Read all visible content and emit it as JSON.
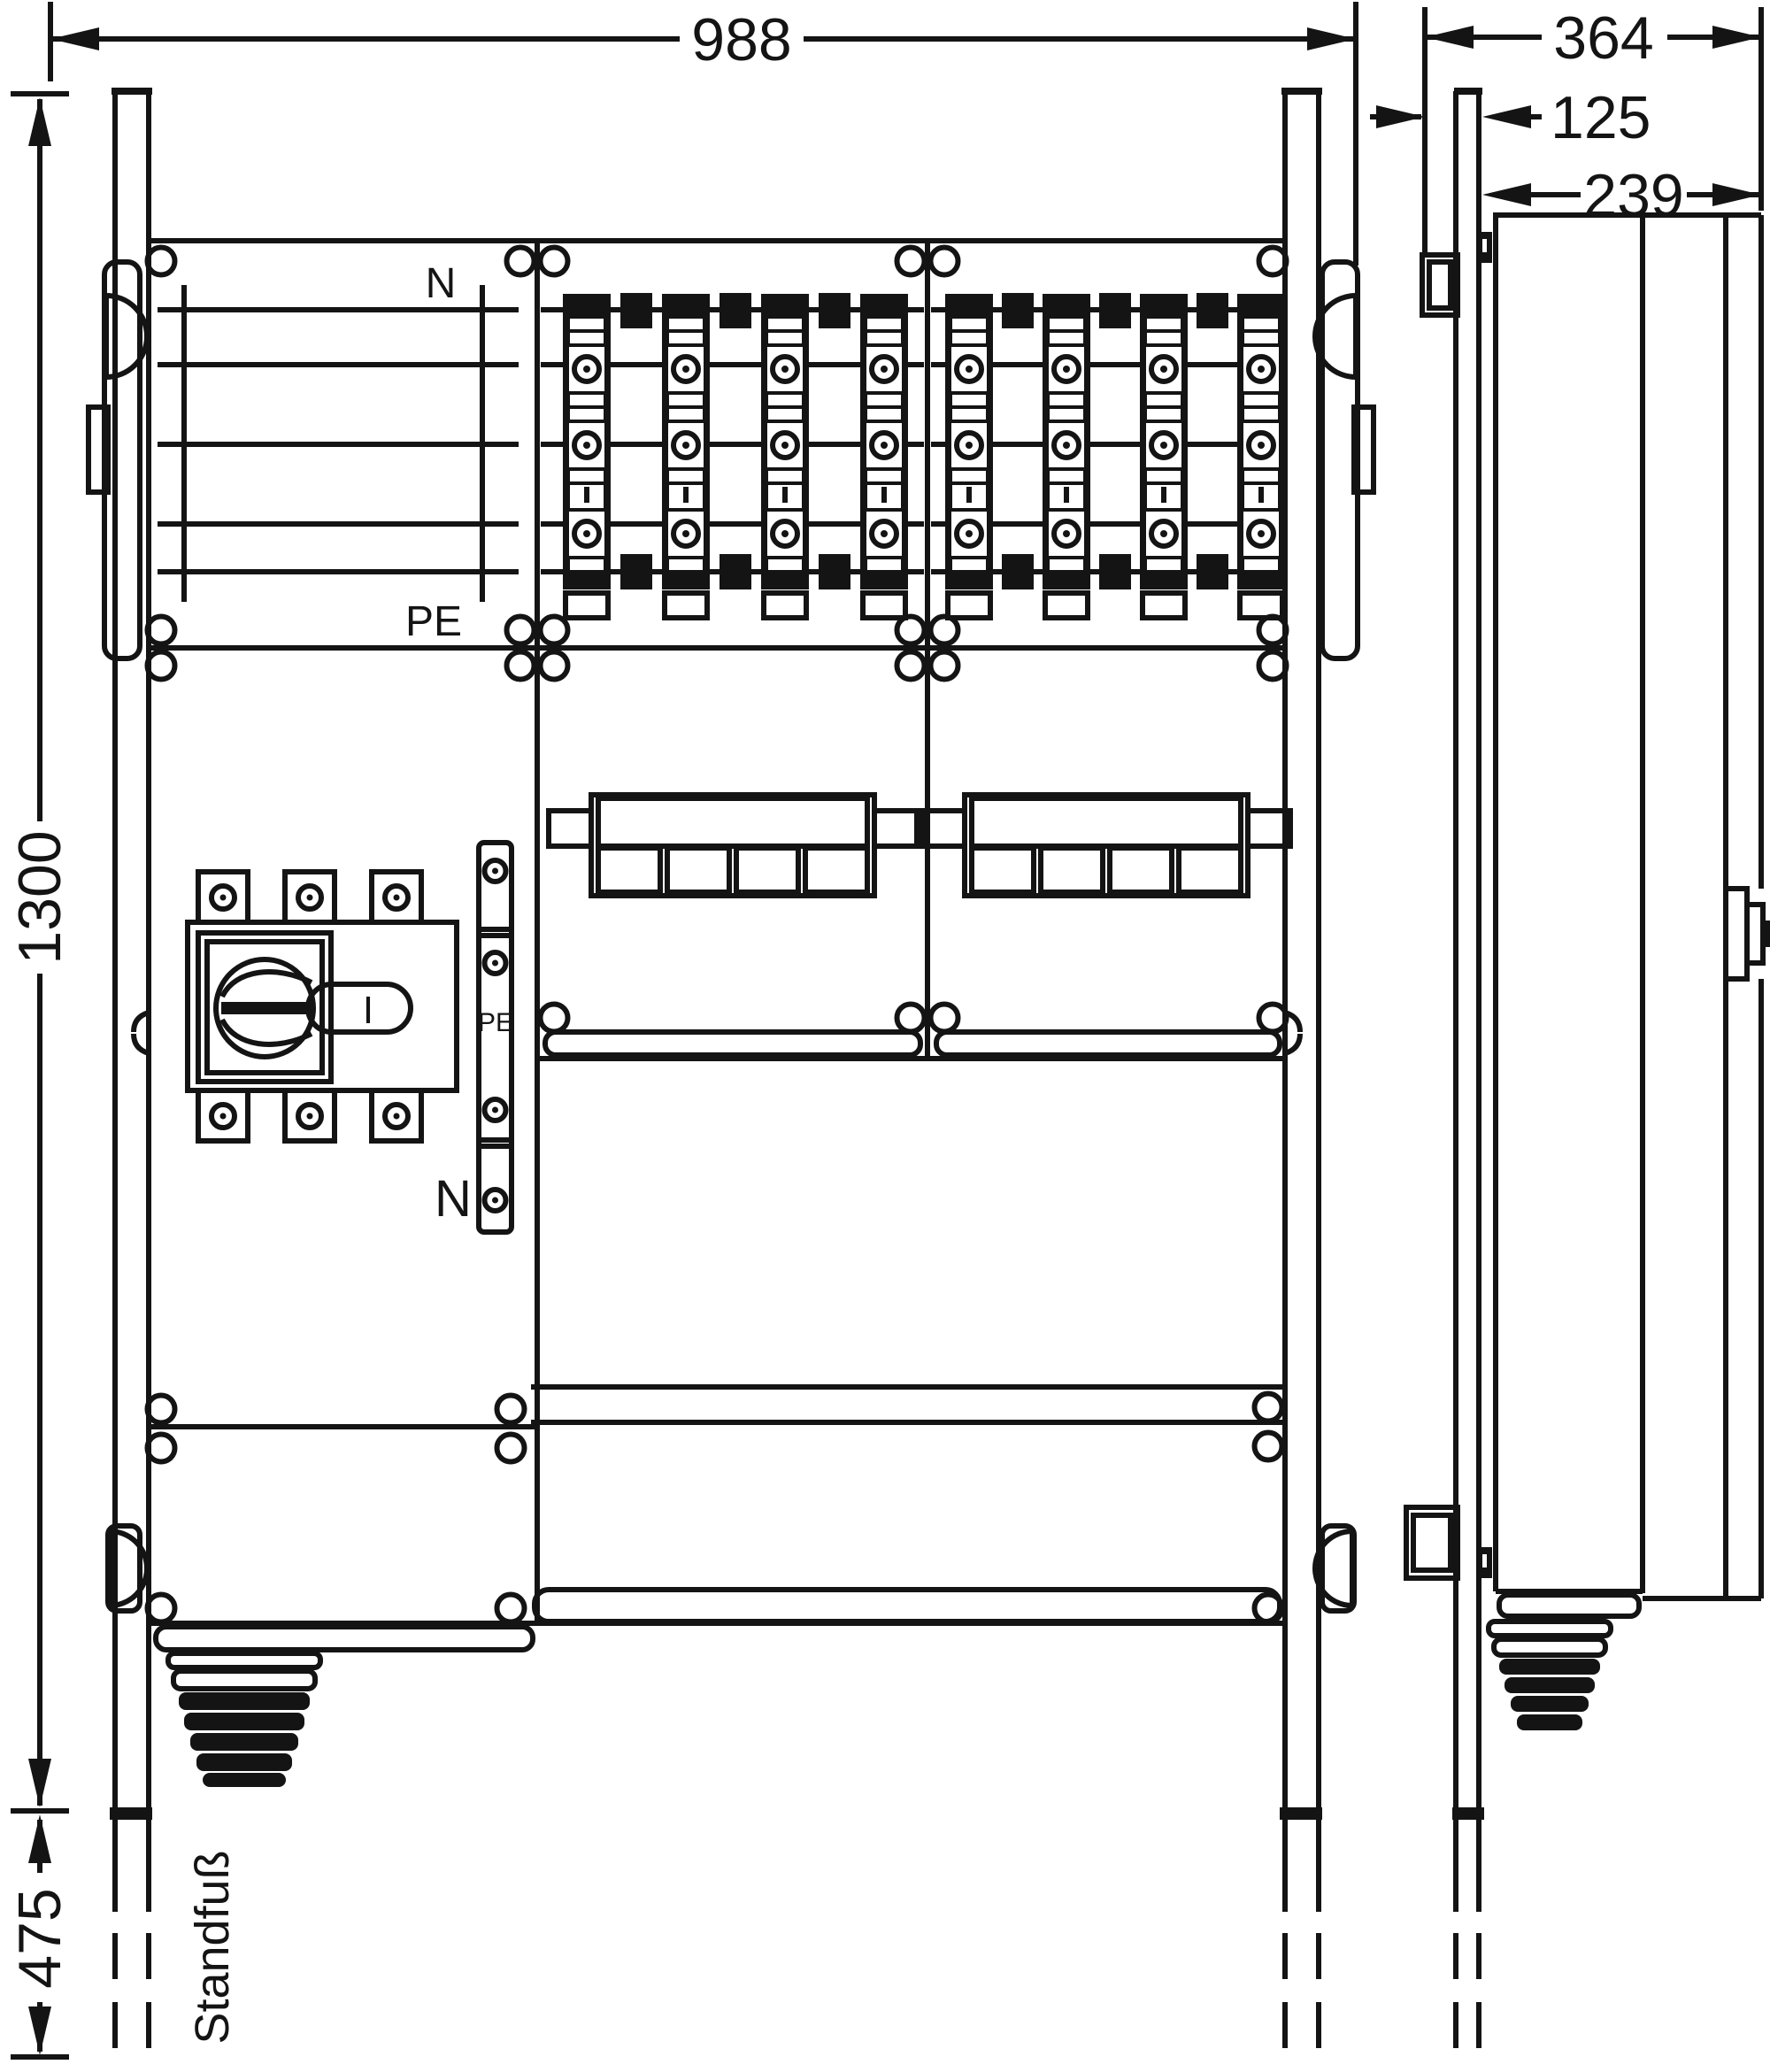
{
  "drawing": {
    "dimensions": {
      "width": "988",
      "height": "1300",
      "stand": "475",
      "depth_total": "364",
      "wall_clearance": "125",
      "body_depth": "239"
    },
    "labels": {
      "neutral_top": "N",
      "pe_top": "PE",
      "pe_strip": "PE",
      "neutral_strip": "N",
      "stand_foot": "Standfuß"
    },
    "switch": {
      "position": "I"
    },
    "colors": {
      "line": "#141414",
      "background": "#ffffff"
    }
  }
}
